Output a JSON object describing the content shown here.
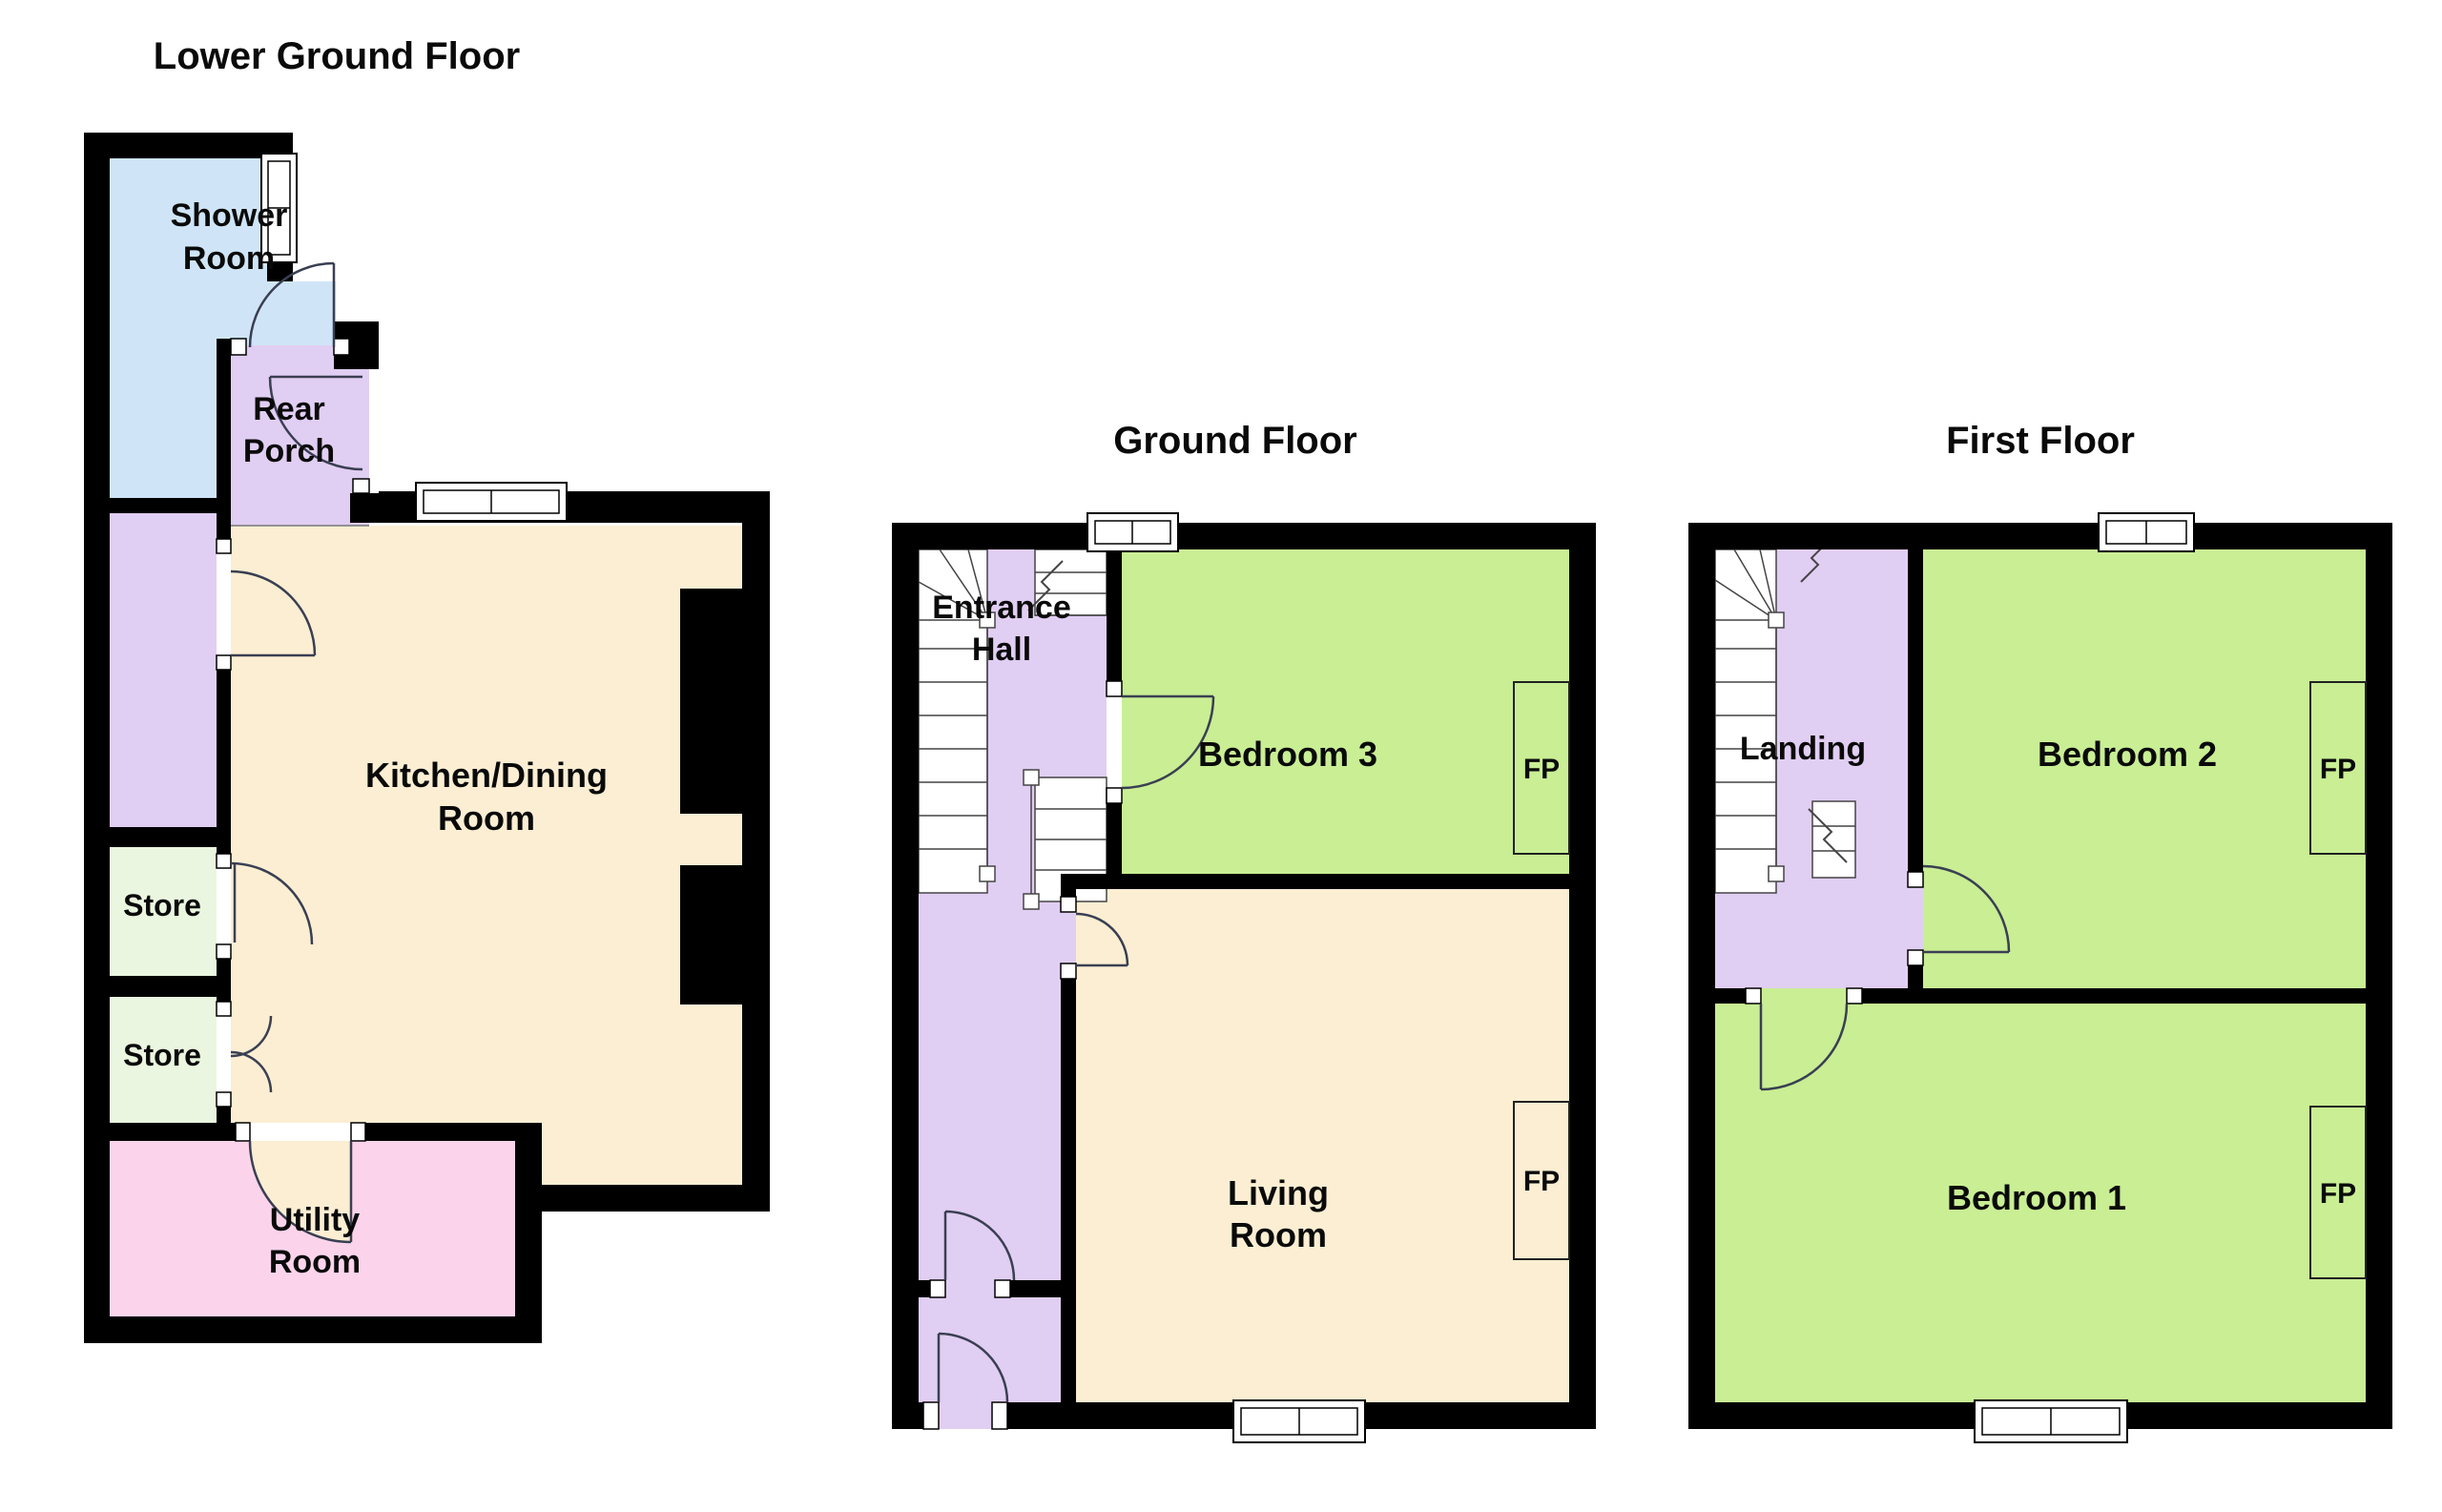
{
  "titles": {
    "lower_ground": "Lower Ground Floor",
    "ground": "Ground Floor",
    "first": "First Floor"
  },
  "rooms": {
    "shower": {
      "line1": "Shower",
      "line2": "Room"
    },
    "rear_porch": {
      "line1": "Rear",
      "line2": "Porch"
    },
    "kitchen": {
      "line1": "Kitchen/Dining",
      "line2": "Room"
    },
    "store_upper": {
      "label": "Store"
    },
    "store_lower": {
      "label": "Store"
    },
    "utility": {
      "line1": "Utility",
      "line2": "Room"
    },
    "entrance_hall": {
      "line1": "Entrance",
      "line2": "Hall"
    },
    "bedroom3": {
      "label": "Bedroom 3"
    },
    "living": {
      "line1": "Living",
      "line2": "Room"
    },
    "landing": {
      "label": "Landing"
    },
    "bedroom2": {
      "label": "Bedroom 2"
    },
    "bedroom1": {
      "label": "Bedroom 1"
    }
  },
  "fireplace_label": "FP",
  "colors": {
    "wall": "#000000",
    "shower": "#cfe5f7",
    "hall": "#e1cef3",
    "kitchen": "#fbeed3",
    "store": "#eaf6df",
    "utility": "#fbd4eb",
    "bedroom": "#c9ee94"
  }
}
